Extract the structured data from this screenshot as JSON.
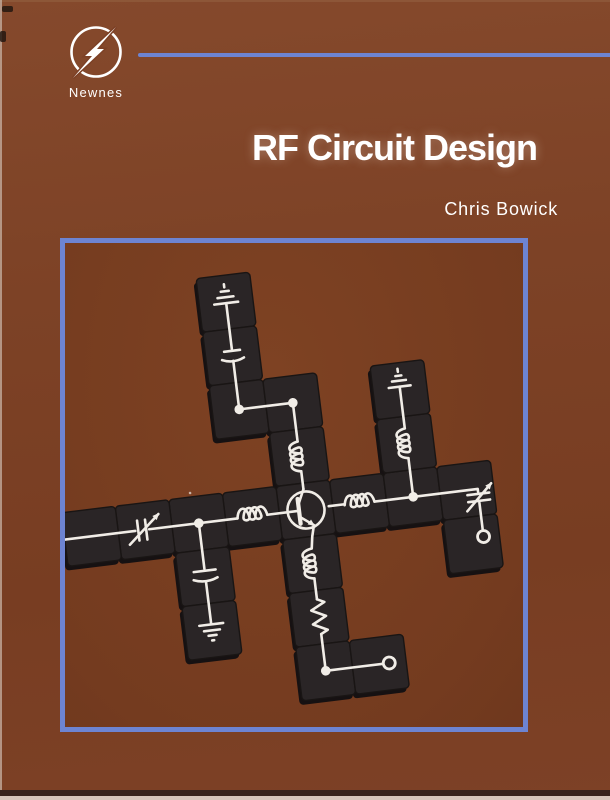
{
  "book": {
    "title": "RF Circuit Design",
    "author": "Chris Bowick",
    "publisher": "Newnes"
  },
  "colors": {
    "cover_brown": "#7d4126",
    "accent_blue": "#6d84d2",
    "tile_black": "#2a2526",
    "symbol_white": "#f1ede7"
  },
  "cover_art": {
    "description": "Photograph of black tiles arranged in a rotated cross, printed with a white RF amplifier schematic",
    "components": [
      "ground-top",
      "capacitor",
      "junction-dot",
      "corner-dot",
      "inductor-vertical",
      "transistor-npn",
      "inductor-horizontal-left",
      "junction-left",
      "variable-capacitor-left",
      "wire",
      "capacitor-down",
      "ground-down",
      "inductor-below",
      "resistor",
      "corner-bottom",
      "output-terminal-bottom",
      "inductor-horizontal-right",
      "junction-right",
      "inductor-right-up",
      "ground-right-top",
      "variable-capacitor-right",
      "output-terminal-right"
    ]
  }
}
